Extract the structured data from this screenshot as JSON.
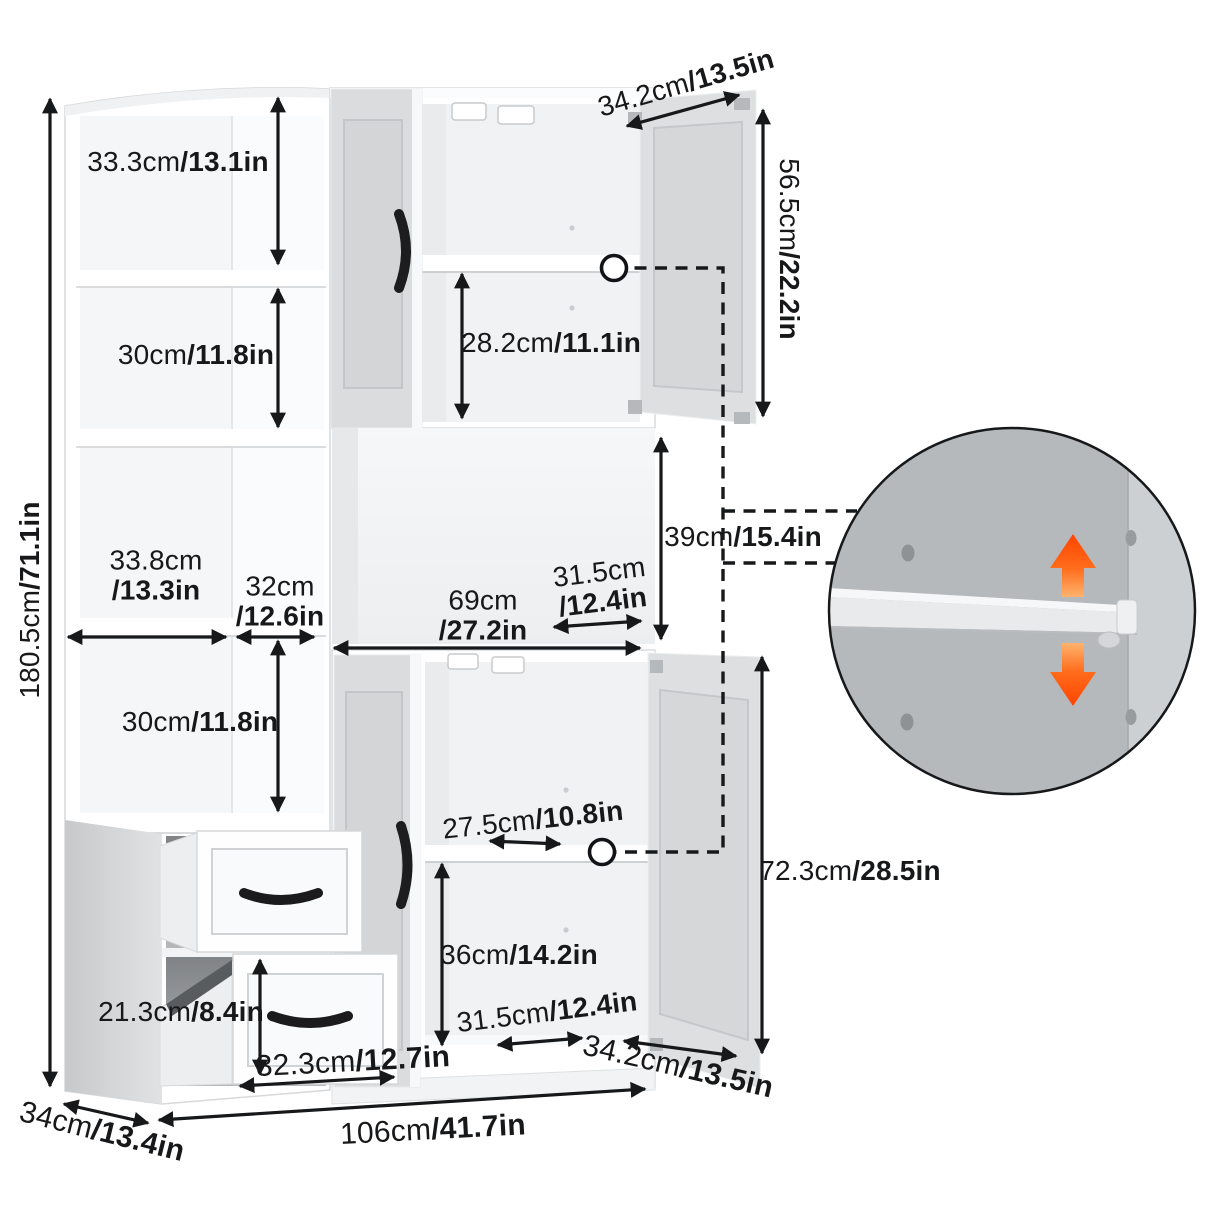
{
  "dims": {
    "overall_height": {
      "cm": "180.5cm",
      "in": "/71.1in"
    },
    "upper_shelf_space": {
      "cm": "33.3cm",
      "in": "/13.1in"
    },
    "second_shelf_space": {
      "cm": "30cm",
      "in": "/11.8in"
    },
    "left_cubby_width": {
      "cm": "33.8cm",
      "in": "/13.3in"
    },
    "right_cubby_width": {
      "cm": "32cm",
      "in": "/12.6in"
    },
    "fourth_shelf_space": {
      "cm": "30cm",
      "in": "/11.8in"
    },
    "hutch_opening_width": {
      "cm": "69cm",
      "in": "/27.2in"
    },
    "hutch_opening_depth": {
      "cm": "31.5cm",
      "in": "/12.4in"
    },
    "top_door_width": {
      "cm": "34.2cm",
      "in": "/13.5in"
    },
    "top_cabinet_height": {
      "cm": "56.5cm",
      "in": "/22.2in"
    },
    "top_cabinet_shelf_space": {
      "cm": "28.2cm",
      "in": "/11.1in"
    },
    "hutch_opening_height": {
      "cm": "39cm",
      "in": "/15.4in"
    },
    "bottom_shelf_depth": {
      "cm": "27.5cm",
      "in": "/10.8in"
    },
    "bottom_space_height": {
      "cm": "36cm",
      "in": "/14.2in"
    },
    "bottom_opening_depth": {
      "cm": "31.5cm",
      "in": "/12.4in"
    },
    "bottom_door_width": {
      "cm": "34.2cm",
      "in": "/13.5in"
    },
    "bottom_door_height": {
      "cm": "72.3cm",
      "in": "/28.5in"
    },
    "drawer_height": {
      "cm": "21.3cm",
      "in": "/8.4in"
    },
    "drawer_width": {
      "cm": "32.3cm",
      "in": "/12.7in"
    },
    "overall_width": {
      "cm": "106cm",
      "in": "/41.7in"
    },
    "overall_depth": {
      "cm": "34cm",
      "in": "/13.4in"
    }
  },
  "icons": {
    "shelf_pin_marker": "white circle on shelf edge",
    "adjust_up_arrow": "orange up arrow (adjustable shelf)",
    "adjust_down_arrow": "orange down arrow (adjustable shelf)"
  },
  "colors": {
    "dimension_line": "#17181a",
    "door_gray": "#d9dbdd",
    "inset_back_wall": "#b6b9bc",
    "arrow_orange_bright": "#ff4400",
    "arrow_orange_light": "#ffb36e"
  }
}
